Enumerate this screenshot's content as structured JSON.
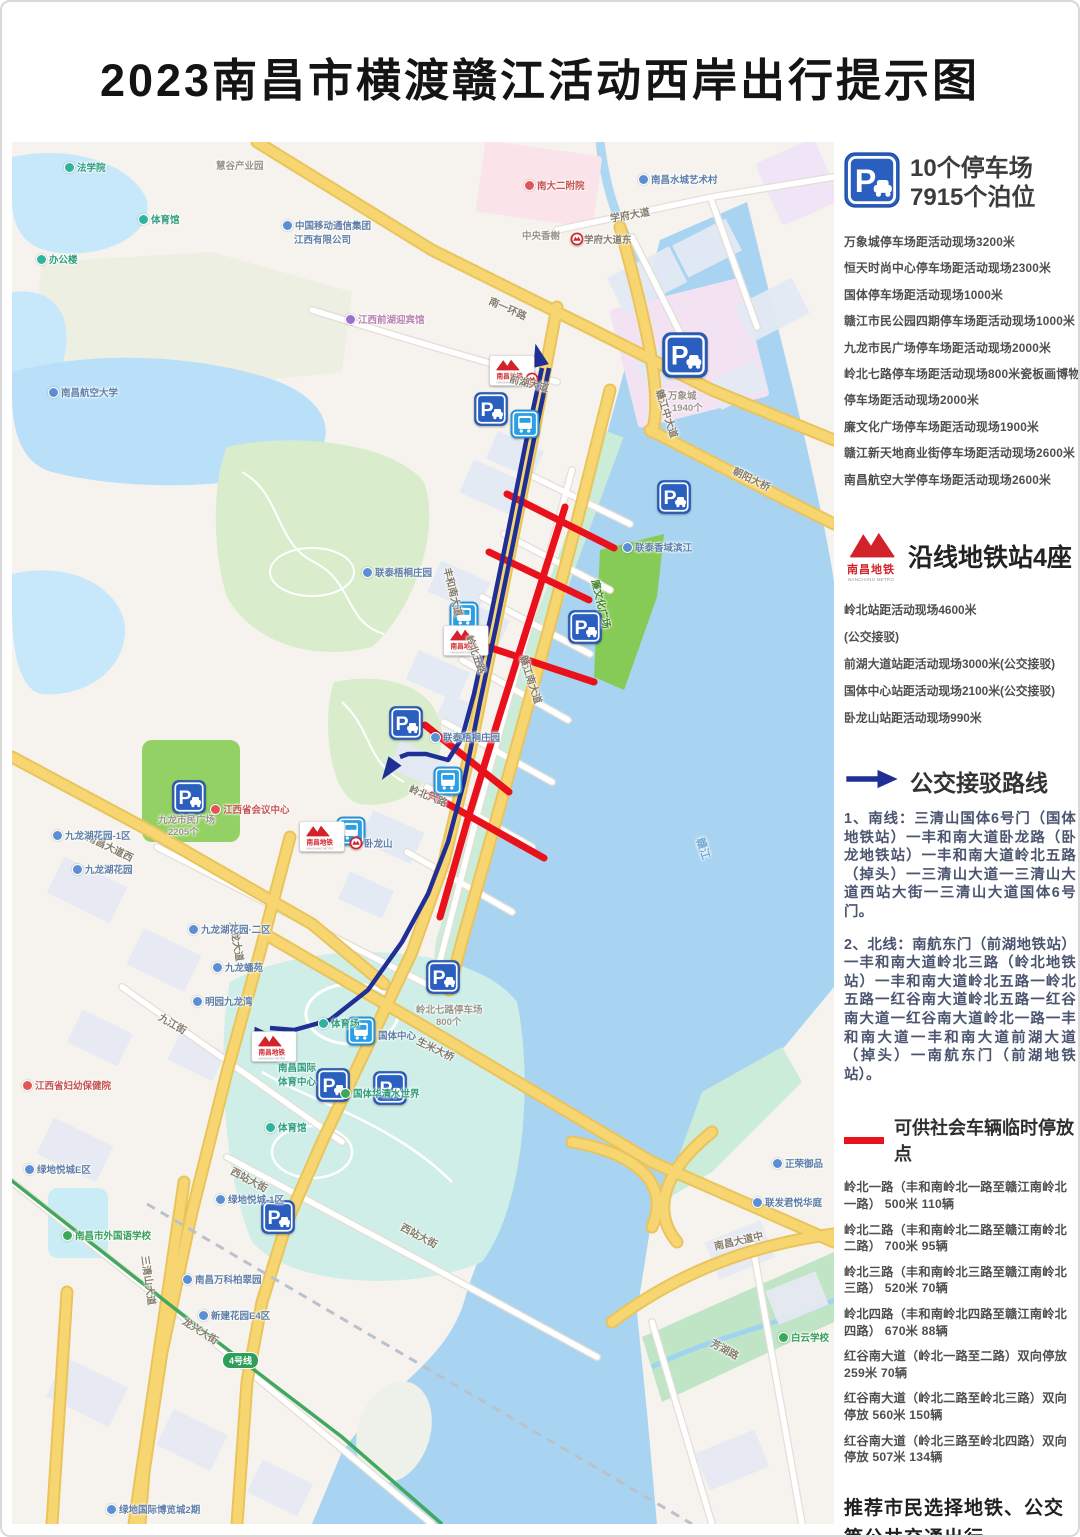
{
  "title": "2023南昌市横渡赣江活动西岸出行提示图",
  "panel": {
    "parking": {
      "icon": "parking-sign-icon",
      "heading_line1": "10个停车场",
      "heading_line2": "7915个泊位",
      "items": [
        "万象城停车场距活动现场3200米",
        "恒天时尚中心停车场距活动现场2300米",
        "国体停车场距活动现场1000米",
        "赣江市民公园四期停车场距活动现场1000米",
        "九龙市民广场停车场距活动现场2000米",
        "岭北七路停车场距活动现场800米瓷板画博物馆",
        "停车场距活动现场2000米",
        "廉文化广场停车场距活动现场1900米",
        "赣江新天地商业街停车场距活动现场2600米",
        "南昌航空大学停车场距活动现场2600米"
      ]
    },
    "metro": {
      "logo_cn": "南昌地铁",
      "logo_en": "NANCHANG METRO",
      "heading": "沿线地铁站4座",
      "items": [
        "岭北站距活动现场4600米",
        "(公交接驳)",
        "前湖大道站距活动现场3000米(公交接驳)",
        "国体中心站距活动现场2100米(公交接驳)",
        "卧龙山站距活动现场990米"
      ]
    },
    "bus": {
      "heading": "公交接驳路线",
      "routes": [
        "1、南线：三清山国体6号门（国体地铁站）一丰和南大道卧龙路（卧龙地铁站）一丰和南大道岭北五路（掉头）一三清山大道一三清山大道西站大街一三清山大道国体6号门。",
        "2、北线：南航东门（前湖地铁站）一丰和南大道岭北三路（岭北地铁站）一丰和南大道岭北五路一岭北五路一红谷南大道岭北五路一红谷南大道一红谷南大道岭北一路一丰和南大道一丰和南大道前湖大道（掉头）一南航东门（前湖地铁站）。"
      ]
    },
    "temp_parking": {
      "heading": "可供社会车辆临时停放点",
      "items": [
        "岭北一路（丰和南岭北一路至赣江南岭北一路）  500米  110辆",
        "岭北二路（丰和南岭北二路至赣江南岭北二路）  700米  95辆",
        "岭北三路（丰和南岭北三路至赣江南岭北三路）  520米  70辆",
        "岭北四路（丰和南岭北四路至赣江南岭北四路）  670米  88辆",
        "红谷南大道（岭北一路至二路）双向停放  259米  70辆",
        "红谷南大道（岭北二路至岭北三路）双向停放  560米  150辆",
        "红谷南大道（岭北三路至岭北四路）双向停放  507米  134辆"
      ]
    },
    "recommendation": "推荐市民选择地铁、公交等公共交通出行"
  },
  "map": {
    "road_labels": [
      {
        "t": "南一环路",
        "x": 478,
        "y": 150,
        "r": 24
      },
      {
        "t": "学府大道",
        "x": 598,
        "y": 68,
        "r": -10
      },
      {
        "t": "前湖大道",
        "x": 498,
        "y": 228,
        "r": 14
      },
      {
        "t": "赣江中大道",
        "x": 648,
        "y": 240,
        "r": 72
      },
      {
        "t": "朝阳大桥",
        "x": 722,
        "y": 320,
        "r": 26
      },
      {
        "t": "丰和南大道",
        "x": 436,
        "y": 418,
        "r": 76
      },
      {
        "t": "岭北五路",
        "x": 458,
        "y": 486,
        "r": 70
      },
      {
        "t": "岭北六路",
        "x": 398,
        "y": 638,
        "r": 22
      },
      {
        "t": "赣江南大道",
        "x": 512,
        "y": 506,
        "r": 72
      },
      {
        "t": "廉文化广场",
        "x": 584,
        "y": 430,
        "r": 76,
        "c": "dgreen"
      },
      {
        "t": "生米大桥",
        "x": 406,
        "y": 890,
        "r": 26
      },
      {
        "t": "南昌大道西",
        "x": 76,
        "y": 686,
        "r": 26
      },
      {
        "t": "九龙大道",
        "x": 222,
        "y": 772,
        "r": 80
      },
      {
        "t": "九江街",
        "x": 148,
        "y": 866,
        "r": 30
      },
      {
        "t": "西站大街",
        "x": 220,
        "y": 1020,
        "r": 28
      },
      {
        "t": "西站大街",
        "x": 390,
        "y": 1076,
        "r": 28
      },
      {
        "t": "南昌大道中",
        "x": 702,
        "y": 1096,
        "r": -13
      },
      {
        "t": "三清山大道",
        "x": 134,
        "y": 1106,
        "r": 82
      },
      {
        "t": "龙兴大街",
        "x": 172,
        "y": 1170,
        "r": 32
      },
      {
        "t": "芳湖路",
        "x": 700,
        "y": 1192,
        "r": 28
      },
      {
        "t": "赣江",
        "x": 688,
        "y": 688,
        "r": 72,
        "c": "water"
      }
    ],
    "landmarks": [
      {
        "t": "法学院",
        "x": 52,
        "y": 18,
        "d": "teal",
        "c": "teal"
      },
      {
        "t": "体育馆",
        "x": 126,
        "y": 70,
        "d": "teal",
        "c": "teal"
      },
      {
        "t": "办公楼",
        "x": 24,
        "y": 110,
        "d": "teal",
        "c": "teal"
      },
      {
        "t": "慧谷产业园",
        "x": 204,
        "y": 16,
        "c": "gray"
      },
      {
        "t": "南昌水城艺术村",
        "x": 626,
        "y": 30,
        "d": "blue",
        "c": "blue"
      },
      {
        "t": "南大二附院",
        "x": 512,
        "y": 36,
        "d": "red",
        "c": "red"
      },
      {
        "t": "中央香榭",
        "x": 510,
        "y": 86,
        "c": "gray"
      },
      {
        "t": "中国移动通信集团",
        "x": 270,
        "y": 76,
        "d": "blue",
        "c": "blue"
      },
      {
        "t": "江西有限公司",
        "x": 282,
        "y": 90,
        "c": "blue"
      },
      {
        "t": "学府大道东",
        "x": 572,
        "y": 90,
        "c": "road"
      },
      {
        "t": "江西前湖迎宾馆",
        "x": 333,
        "y": 170,
        "d": "purple",
        "c": "pink"
      },
      {
        "t": "南昌航空大学",
        "x": 36,
        "y": 243,
        "d": "blue",
        "c": "blue"
      },
      {
        "t": "万象城",
        "x": 656,
        "y": 246,
        "c": "gray"
      },
      {
        "t": "1940个",
        "x": 660,
        "y": 258,
        "c": "gray"
      },
      {
        "t": "联泰香域滨江",
        "x": 610,
        "y": 398,
        "d": "blue",
        "c": "blue"
      },
      {
        "t": "联泰梧桐庄园",
        "x": 350,
        "y": 423,
        "d": "blue",
        "c": "blue"
      },
      {
        "t": "联泰梧桐庄园",
        "x": 418,
        "y": 588,
        "d": "blue",
        "c": "blue"
      },
      {
        "t": "江西省会议中心",
        "x": 198,
        "y": 660,
        "d": "red",
        "c": "red"
      },
      {
        "t": "九龙市民广场",
        "x": 146,
        "y": 670,
        "c": "gray"
      },
      {
        "t": "2205个",
        "x": 156,
        "y": 682,
        "c": "gray"
      },
      {
        "t": "卧龙山",
        "x": 352,
        "y": 694,
        "c": "blue"
      },
      {
        "t": "九龙湖花园-1区",
        "x": 40,
        "y": 686,
        "d": "blue",
        "c": "blue"
      },
      {
        "t": "九龙湖花园",
        "x": 60,
        "y": 720,
        "d": "blue",
        "c": "blue"
      },
      {
        "t": "九龙湖花园·二区",
        "x": 176,
        "y": 780,
        "d": "blue",
        "c": "blue"
      },
      {
        "t": "九龙蟠苑",
        "x": 200,
        "y": 818,
        "d": "blue",
        "c": "blue"
      },
      {
        "t": "明园九龙湾",
        "x": 180,
        "y": 852,
        "d": "blue",
        "c": "blue"
      },
      {
        "t": "国体中心",
        "x": 366,
        "y": 886,
        "c": "blue"
      },
      {
        "t": "南昌国际",
        "x": 266,
        "y": 918,
        "c": "teal"
      },
      {
        "t": "体育中心",
        "x": 266,
        "y": 932,
        "c": "teal"
      },
      {
        "t": "体育场",
        "x": 306,
        "y": 874,
        "d": "teal",
        "c": "teal"
      },
      {
        "t": "体育馆",
        "x": 253,
        "y": 978,
        "d": "teal",
        "c": "teal"
      },
      {
        "t": "国体华清水世界",
        "x": 328,
        "y": 944,
        "d": "green",
        "c": "teal"
      },
      {
        "t": "岭北七路停车场",
        "x": 404,
        "y": 860,
        "c": "gray"
      },
      {
        "t": "800个",
        "x": 424,
        "y": 872,
        "c": "gray"
      },
      {
        "t": "江西省妇幼保健院",
        "x": 10,
        "y": 936,
        "d": "red",
        "c": "red"
      },
      {
        "t": "绿地悦城E区",
        "x": 12,
        "y": 1020,
        "d": "blue",
        "c": "blue"
      },
      {
        "t": "绿地悦城-1区",
        "x": 203,
        "y": 1050,
        "d": "blue",
        "c": "blue"
      },
      {
        "t": "南昌市外国语学校",
        "x": 50,
        "y": 1086,
        "d": "green",
        "c": "green"
      },
      {
        "t": "南昌万科柏翠园",
        "x": 170,
        "y": 1130,
        "d": "blue",
        "c": "blue"
      },
      {
        "t": "新建花园E4区",
        "x": 186,
        "y": 1166,
        "d": "blue",
        "c": "blue"
      },
      {
        "t": "正荣御品",
        "x": 760,
        "y": 1014,
        "d": "blue",
        "c": "blue"
      },
      {
        "t": "联发君悦华庭",
        "x": 740,
        "y": 1053,
        "d": "blue",
        "c": "blue"
      },
      {
        "t": "白云学校",
        "x": 766,
        "y": 1188,
        "d": "green",
        "c": "green"
      },
      {
        "t": "绿地国际博览城2期",
        "x": 94,
        "y": 1360,
        "d": "blue",
        "c": "blue"
      }
    ],
    "parking_icons": [
      {
        "x": 462,
        "y": 250,
        "s": 34
      },
      {
        "x": 645,
        "y": 338,
        "s": 34
      },
      {
        "x": 556,
        "y": 468,
        "s": 34
      },
      {
        "x": 377,
        "y": 564,
        "s": 34
      },
      {
        "x": 650,
        "y": 190,
        "s": 46
      },
      {
        "x": 160,
        "y": 638,
        "s": 34
      },
      {
        "x": 414,
        "y": 818,
        "s": 34
      },
      {
        "x": 304,
        "y": 926,
        "s": 34
      },
      {
        "x": 361,
        "y": 929,
        "s": 34
      },
      {
        "x": 249,
        "y": 1058,
        "s": 34
      }
    ],
    "bus_icons": [
      {
        "x": 498,
        "y": 267
      },
      {
        "x": 437,
        "y": 459
      },
      {
        "x": 421,
        "y": 624
      },
      {
        "x": 324,
        "y": 674
      },
      {
        "x": 334,
        "y": 874
      }
    ],
    "metro_boxes": [
      {
        "x": 477,
        "y": 213
      },
      {
        "x": 431,
        "y": 483
      },
      {
        "x": 287,
        "y": 679
      },
      {
        "x": 239,
        "y": 889
      }
    ],
    "station_roundels": [
      {
        "x": 513,
        "y": 230
      },
      {
        "x": 337,
        "y": 694
      },
      {
        "x": 558,
        "y": 90
      }
    ],
    "badges": [
      {
        "t": "4号线",
        "x": 210,
        "y": 1210,
        "bg": "#2e9e5b"
      }
    ]
  },
  "colors": {
    "route_navy": "#1f2f96",
    "temp_parking_red": "#e8111c",
    "metro_red": "#d3232a",
    "parking_blue": "#2a5fc0",
    "bus_blue": "#2a9fe5",
    "line4_green": "#2e9e5b",
    "water": "#a9d4f1",
    "major_road_yellow": "#f7d671"
  }
}
